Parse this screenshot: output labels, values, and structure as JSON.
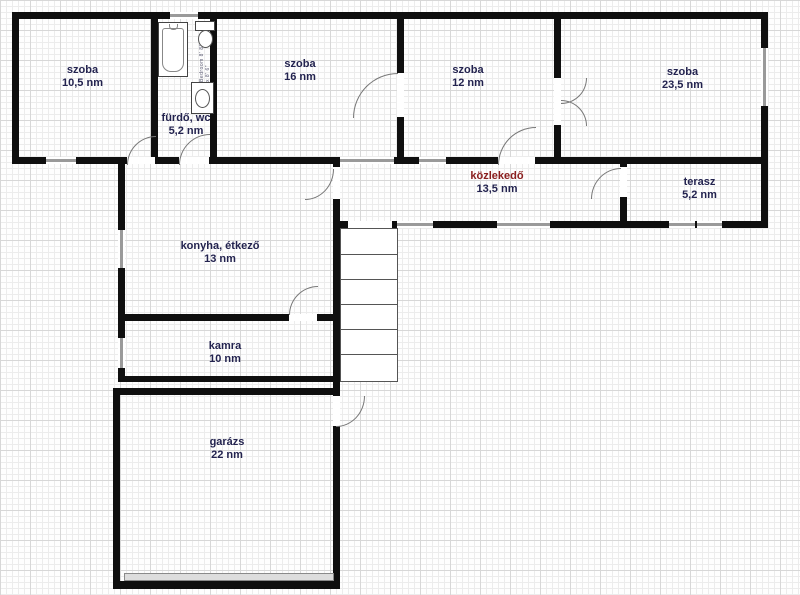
{
  "rooms": [
    {
      "id": "szoba-105",
      "name": "szoba",
      "area": "10,5 nm"
    },
    {
      "id": "furdo-wc",
      "name": "fürdő, wc",
      "area": "5,2 nm"
    },
    {
      "id": "szoba-16",
      "name": "szoba",
      "area": "16 nm"
    },
    {
      "id": "szoba-12",
      "name": "szoba",
      "area": "12 nm"
    },
    {
      "id": "szoba-235",
      "name": "szoba",
      "area": "23,5 nm"
    },
    {
      "id": "kozlekedo",
      "name": "közlekedő",
      "area": "13,5 nm"
    },
    {
      "id": "terasz",
      "name": "terasz",
      "area": "5,2 nm"
    },
    {
      "id": "konyha-etkezo",
      "name": "konyha, étkező",
      "area": "13 nm"
    },
    {
      "id": "kamra",
      "name": "kamra",
      "area": "10 nm"
    },
    {
      "id": "garazs",
      "name": "garázs",
      "area": "22 nm"
    }
  ],
  "annotations": {
    "bathroom_fixture_label": "Bedroom 8' 8\" x 8' 6\""
  },
  "colors": {
    "wall": "#0f0f0f",
    "room_label": "#23234f",
    "hall_label": "#8b2020",
    "grid_minor": "#ececec",
    "grid_major": "#d7d7d7",
    "window_band": "#9a9a9a"
  }
}
